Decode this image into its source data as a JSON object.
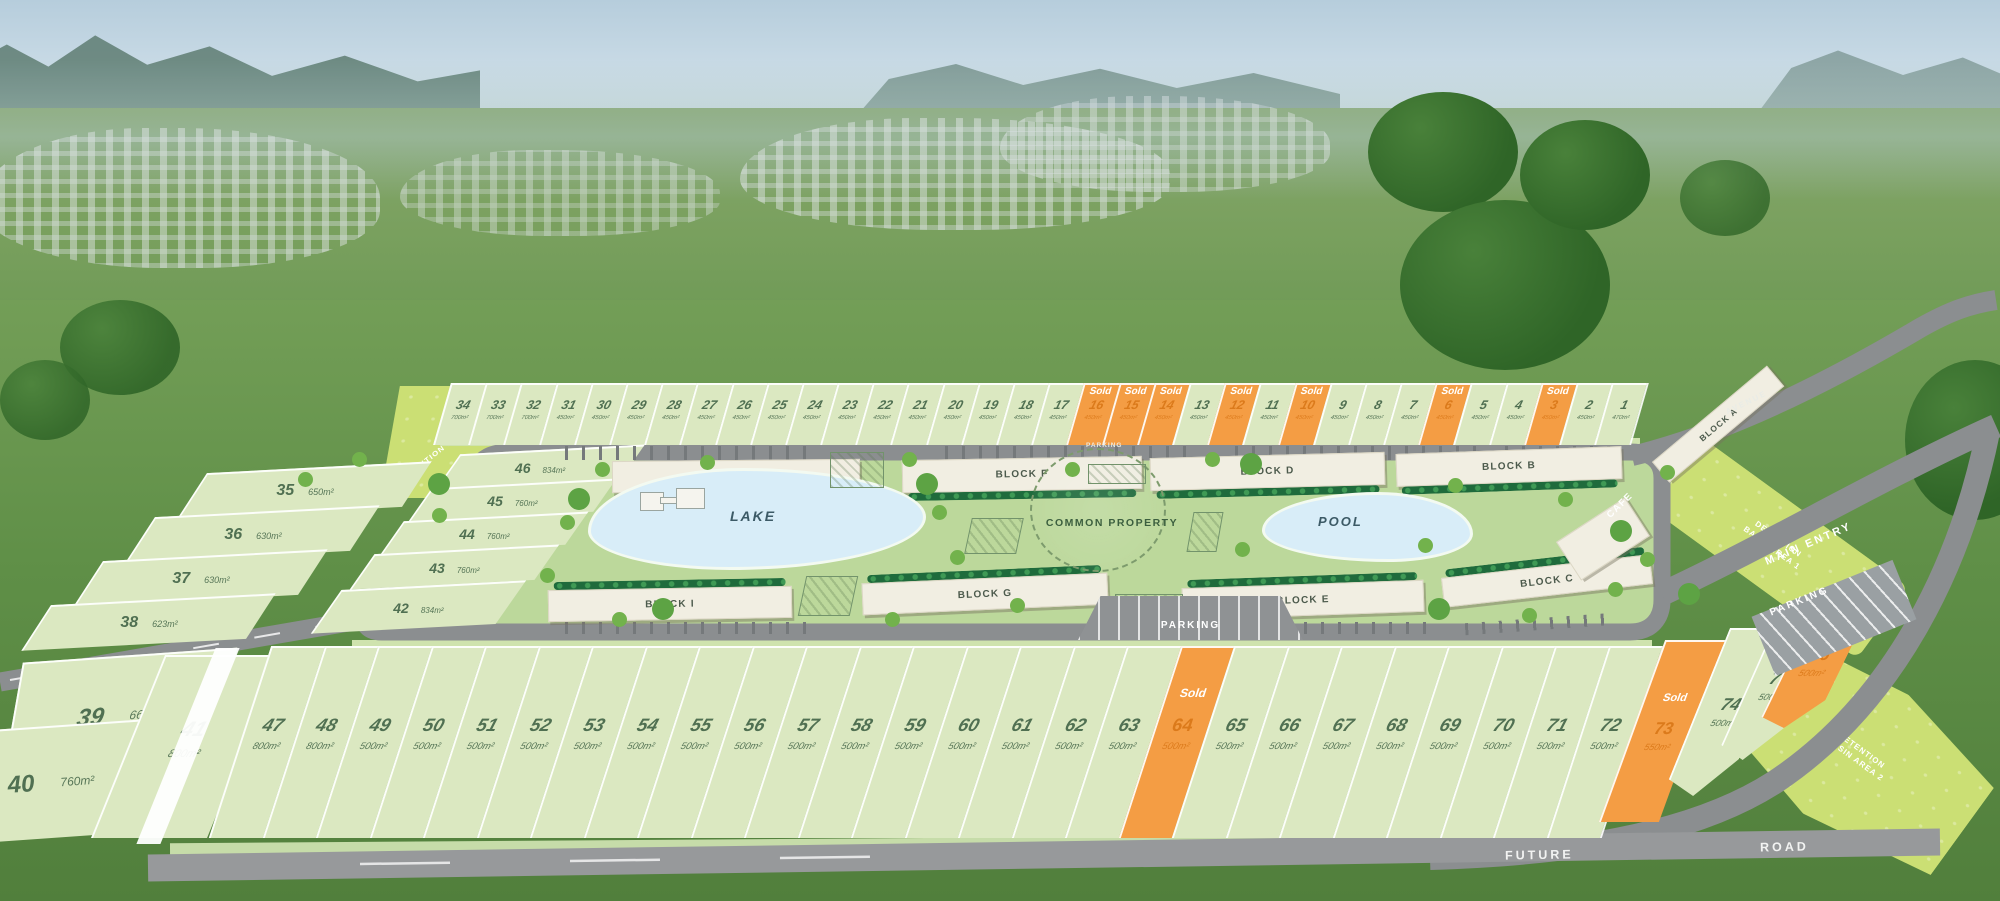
{
  "plan": {
    "sold_label": "Sold",
    "top_row_lots": [
      {
        "num": 34,
        "size": "700m²",
        "sold": false
      },
      {
        "num": 33,
        "size": "700m²",
        "sold": false
      },
      {
        "num": 32,
        "size": "700m²",
        "sold": false
      },
      {
        "num": 31,
        "size": "450m²",
        "sold": false
      },
      {
        "num": 30,
        "size": "450m²",
        "sold": false
      },
      {
        "num": 29,
        "size": "450m²",
        "sold": false
      },
      {
        "num": 28,
        "size": "450m²",
        "sold": false
      },
      {
        "num": 27,
        "size": "450m²",
        "sold": false
      },
      {
        "num": 26,
        "size": "450m²",
        "sold": false
      },
      {
        "num": 25,
        "size": "450m²",
        "sold": false
      },
      {
        "num": 24,
        "size": "450m²",
        "sold": false
      },
      {
        "num": 23,
        "size": "450m²",
        "sold": false
      },
      {
        "num": 22,
        "size": "450m²",
        "sold": false
      },
      {
        "num": 21,
        "size": "450m²",
        "sold": false
      },
      {
        "num": 20,
        "size": "450m²",
        "sold": false
      },
      {
        "num": 19,
        "size": "450m²",
        "sold": false
      },
      {
        "num": 18,
        "size": "450m²",
        "sold": false
      },
      {
        "num": 17,
        "size": "450m²",
        "sold": false
      },
      {
        "num": 16,
        "size": "450m²",
        "sold": true
      },
      {
        "num": 15,
        "size": "450m²",
        "sold": true
      },
      {
        "num": 14,
        "size": "450m²",
        "sold": true
      },
      {
        "num": 13,
        "size": "450m²",
        "sold": false
      },
      {
        "num": 12,
        "size": "450m²",
        "sold": true
      },
      {
        "num": 11,
        "size": "450m²",
        "sold": false
      },
      {
        "num": 10,
        "size": "450m²",
        "sold": true
      },
      {
        "num": 9,
        "size": "450m²",
        "sold": false
      },
      {
        "num": 8,
        "size": "450m²",
        "sold": false
      },
      {
        "num": 7,
        "size": "450m²",
        "sold": false
      },
      {
        "num": 6,
        "size": "450m²",
        "sold": true
      },
      {
        "num": 5,
        "size": "450m²",
        "sold": false
      },
      {
        "num": 4,
        "size": "450m²",
        "sold": false
      },
      {
        "num": 3,
        "size": "450m²",
        "sold": true
      },
      {
        "num": 2,
        "size": "450m²",
        "sold": false
      },
      {
        "num": 1,
        "size": "470m²",
        "sold": false
      }
    ],
    "left_lots": [
      {
        "num": 35,
        "size": "650m²",
        "sold": false
      },
      {
        "num": 36,
        "size": "630m²",
        "sold": false
      },
      {
        "num": 37,
        "size": "630m²",
        "sold": false
      },
      {
        "num": 38,
        "size": "623m²",
        "sold": false
      }
    ],
    "hill_lots": [
      {
        "num": 39,
        "size": "660m²",
        "sold": false
      },
      {
        "num": 40,
        "size": "760m²",
        "sold": false
      },
      {
        "num": 41,
        "size": "800m²",
        "sold": false
      }
    ],
    "inner_lots": [
      {
        "num": 46,
        "size": "834m²",
        "sold": false
      },
      {
        "num": 45,
        "size": "760m²",
        "sold": false
      },
      {
        "num": 44,
        "size": "760m²",
        "sold": false
      },
      {
        "num": 43,
        "size": "760m²",
        "sold": false
      },
      {
        "num": 42,
        "size": "834m²",
        "sold": false
      }
    ],
    "bottom_lots": [
      {
        "num": 47,
        "size": "800m²",
        "sold": false
      },
      {
        "num": 48,
        "size": "800m²",
        "sold": false
      },
      {
        "num": 49,
        "size": "500m²",
        "sold": false
      },
      {
        "num": 50,
        "size": "500m²",
        "sold": false
      },
      {
        "num": 51,
        "size": "500m²",
        "sold": false
      },
      {
        "num": 52,
        "size": "500m²",
        "sold": false
      },
      {
        "num": 53,
        "size": "500m²",
        "sold": false
      },
      {
        "num": 54,
        "size": "500m²",
        "sold": false
      },
      {
        "num": 55,
        "size": "500m²",
        "sold": false
      },
      {
        "num": 56,
        "size": "500m²",
        "sold": false
      },
      {
        "num": 57,
        "size": "500m²",
        "sold": false
      },
      {
        "num": 58,
        "size": "500m²",
        "sold": false
      },
      {
        "num": 59,
        "size": "500m²",
        "sold": false
      },
      {
        "num": 60,
        "size": "500m²",
        "sold": false
      },
      {
        "num": 61,
        "size": "500m²",
        "sold": false
      },
      {
        "num": 62,
        "size": "500m²",
        "sold": false
      },
      {
        "num": 63,
        "size": "500m²",
        "sold": false
      },
      {
        "num": 64,
        "size": "500m²",
        "sold": true
      },
      {
        "num": 65,
        "size": "500m²",
        "sold": false
      },
      {
        "num": 66,
        "size": "500m²",
        "sold": false
      },
      {
        "num": 67,
        "size": "500m²",
        "sold": false
      },
      {
        "num": 68,
        "size": "500m²",
        "sold": false
      },
      {
        "num": 69,
        "size": "500m²",
        "sold": false
      },
      {
        "num": 70,
        "size": "500m²",
        "sold": false
      },
      {
        "num": 71,
        "size": "500m²",
        "sold": false
      },
      {
        "num": 72,
        "size": "500m²",
        "sold": false
      }
    ],
    "bottom_right_lots": [
      {
        "num": 73,
        "size": "550m²",
        "sold": true
      },
      {
        "num": 74,
        "size": "500m²",
        "sold": false
      },
      {
        "num": 75,
        "size": "500m²",
        "sold": false
      },
      {
        "num": 76,
        "size": "500m²",
        "sold": true
      }
    ],
    "blocks": {
      "top": [
        "BLOCK H",
        "BLOCK F",
        "BLOCK D",
        "BLOCK B"
      ],
      "bottom": [
        "BLOCK I",
        "BLOCK G",
        "BLOCK E",
        "BLOCK C"
      ],
      "side": "BLOCK A"
    },
    "amenities": {
      "lake": "LAKE",
      "pool": "POOL",
      "common_property": "COMMON PROPERTY",
      "cafe": "CAFE",
      "parking": "PARKING",
      "main_entry": "MAIN ENTRY"
    },
    "roads": {
      "future": "FUTURE",
      "road": "ROAD",
      "avenue": "AVENUE"
    },
    "zones": {
      "detention_1": "DETENTION BASIN AREA 1",
      "detention_2": "DETENTION BASIN AREA 2",
      "detention_3": "DETENTION BASIN AREA 3"
    },
    "colors": {
      "sold_orange": "#F49D44",
      "lot_fill": "#DBE8C1",
      "lot_text_green": "#507052",
      "road_grey": "#8B8E90",
      "estate_field": "#BCD89B",
      "water_blue": "#D8EDF8",
      "building_cream": "#F1EEE2",
      "hedge_green": "#1F6B3C",
      "detention_yellow_green": "#CBDF74"
    }
  }
}
